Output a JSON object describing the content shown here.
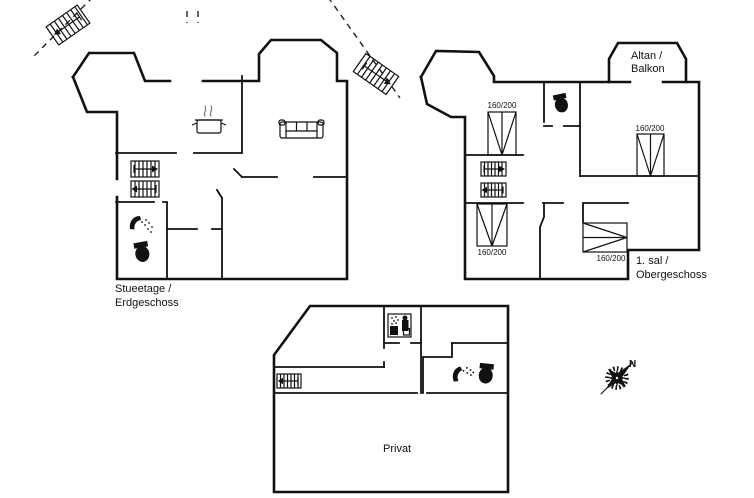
{
  "page": {
    "background": "#ffffff",
    "ink": "#111111"
  },
  "ground_floor": {
    "label_line1": "Stueetage /",
    "label_line2": "Erdgeschoss",
    "icons": [
      "exterior-stairs",
      "exterior-stairs",
      "staircase-up",
      "staircase-down",
      "stove-pot",
      "sofa",
      "shower",
      "toilet"
    ]
  },
  "upper_floor": {
    "label_line1": "1. sal /",
    "label_line2": "Obergeschoss",
    "balcony_label_line1": "Altan /",
    "balcony_label_line2": "Balkon",
    "beds": [
      {
        "size": "160/200"
      },
      {
        "size": "160/200"
      },
      {
        "size": "160/200"
      },
      {
        "size": "160/200"
      }
    ],
    "icons": [
      "staircase-up",
      "staircase-down",
      "toilet"
    ]
  },
  "basement": {
    "label": "Privat",
    "icons": [
      "staircase",
      "sauna",
      "shower",
      "toilet"
    ]
  },
  "compass": {
    "north_label": "N"
  }
}
